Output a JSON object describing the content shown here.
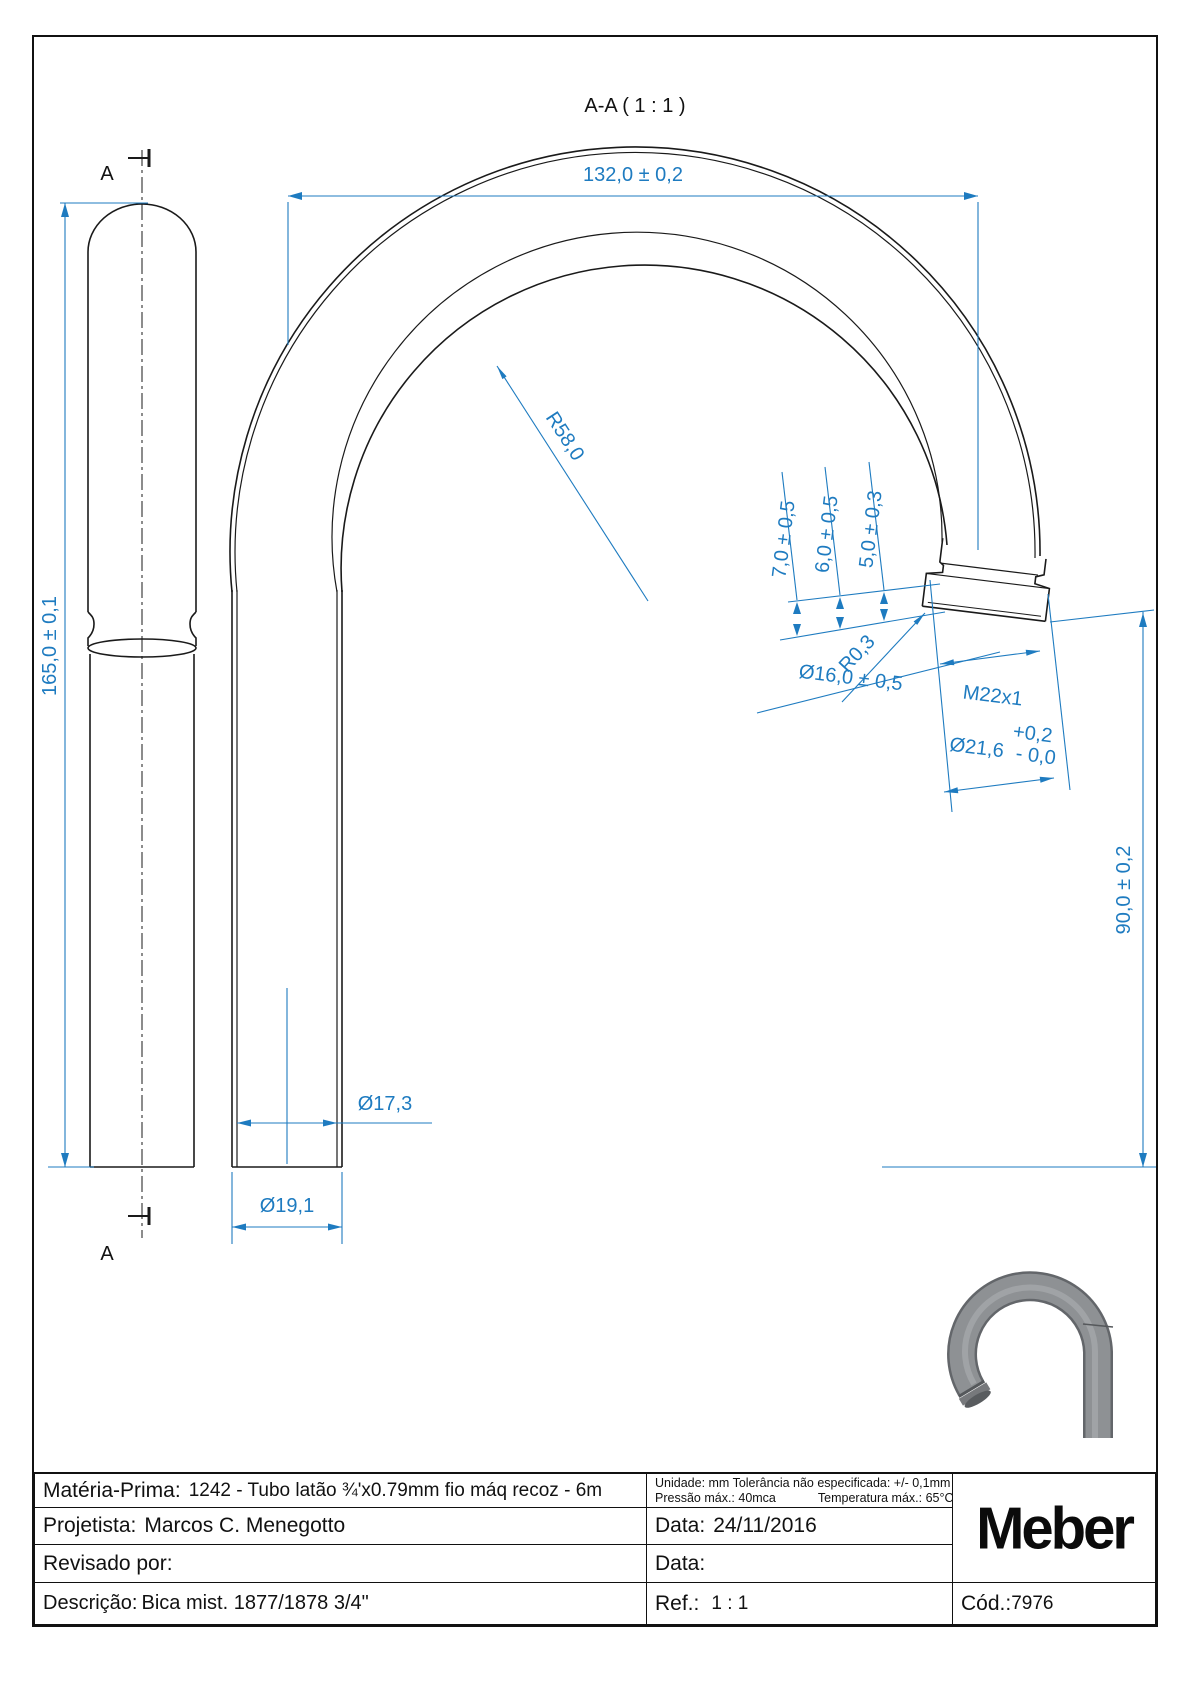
{
  "sheet": {
    "title": "A-A ( 1 : 1 )"
  },
  "colors": {
    "dimension_blue": "#1e7bc0",
    "line_black": "#1a1a1a",
    "render_gray": "#8e9194"
  },
  "side_view": {
    "section_marker_top": "A",
    "section_marker_bottom": "A",
    "height_dim": "165,0 ± 0,1"
  },
  "section_view": {
    "width_dim": "132,0 ± 0,2",
    "bend_radius_dim": "R58,0",
    "tip_step_dims": [
      "7,0 ± 0,5",
      "6,0 ± 0,5",
      "5,0 ± 0,3"
    ],
    "corner_radius_dim": "R0,3",
    "neck_diameter_dim": "Ø16,0 ± 0,5",
    "thread_dim": "M22x1",
    "collar_diameter_dim": "Ø21,6",
    "collar_tol_plus": "+0,2",
    "collar_tol_minus": "- 0,0",
    "outlet_height_dim": "90,0 ± 0,2",
    "inner_diameter_dim": "Ø17,3",
    "outer_diameter_dim": "Ø19,1"
  },
  "title_block": {
    "materia_prima": {
      "label": "Matéria-Prima:",
      "value": "1242 - Tubo latão ¾'x0.79mm fio máq recoz - 6m"
    },
    "notes": {
      "line1": "Unidade: mm Tolerância não especificada: +/- 0,1mm",
      "line2_left": "Pressão máx.: 40mca",
      "line2_right": "Temperatura máx.: 65°C"
    },
    "projetista": {
      "label": "Projetista:",
      "value": "Marcos C. Menegotto"
    },
    "data1": {
      "label": "Data:",
      "value": "24/11/2016"
    },
    "revisado": {
      "label": "Revisado por:",
      "value": ""
    },
    "data2": {
      "label": "Data:",
      "value": ""
    },
    "descricao": {
      "label": "Descrição:",
      "value": "Bica mist. 1877/1878 3/4\""
    },
    "ref": {
      "label": "Ref.:",
      "value": "1 : 1"
    },
    "cod": {
      "label": "Cód.:",
      "value": "7976"
    },
    "logo": "Meber"
  }
}
